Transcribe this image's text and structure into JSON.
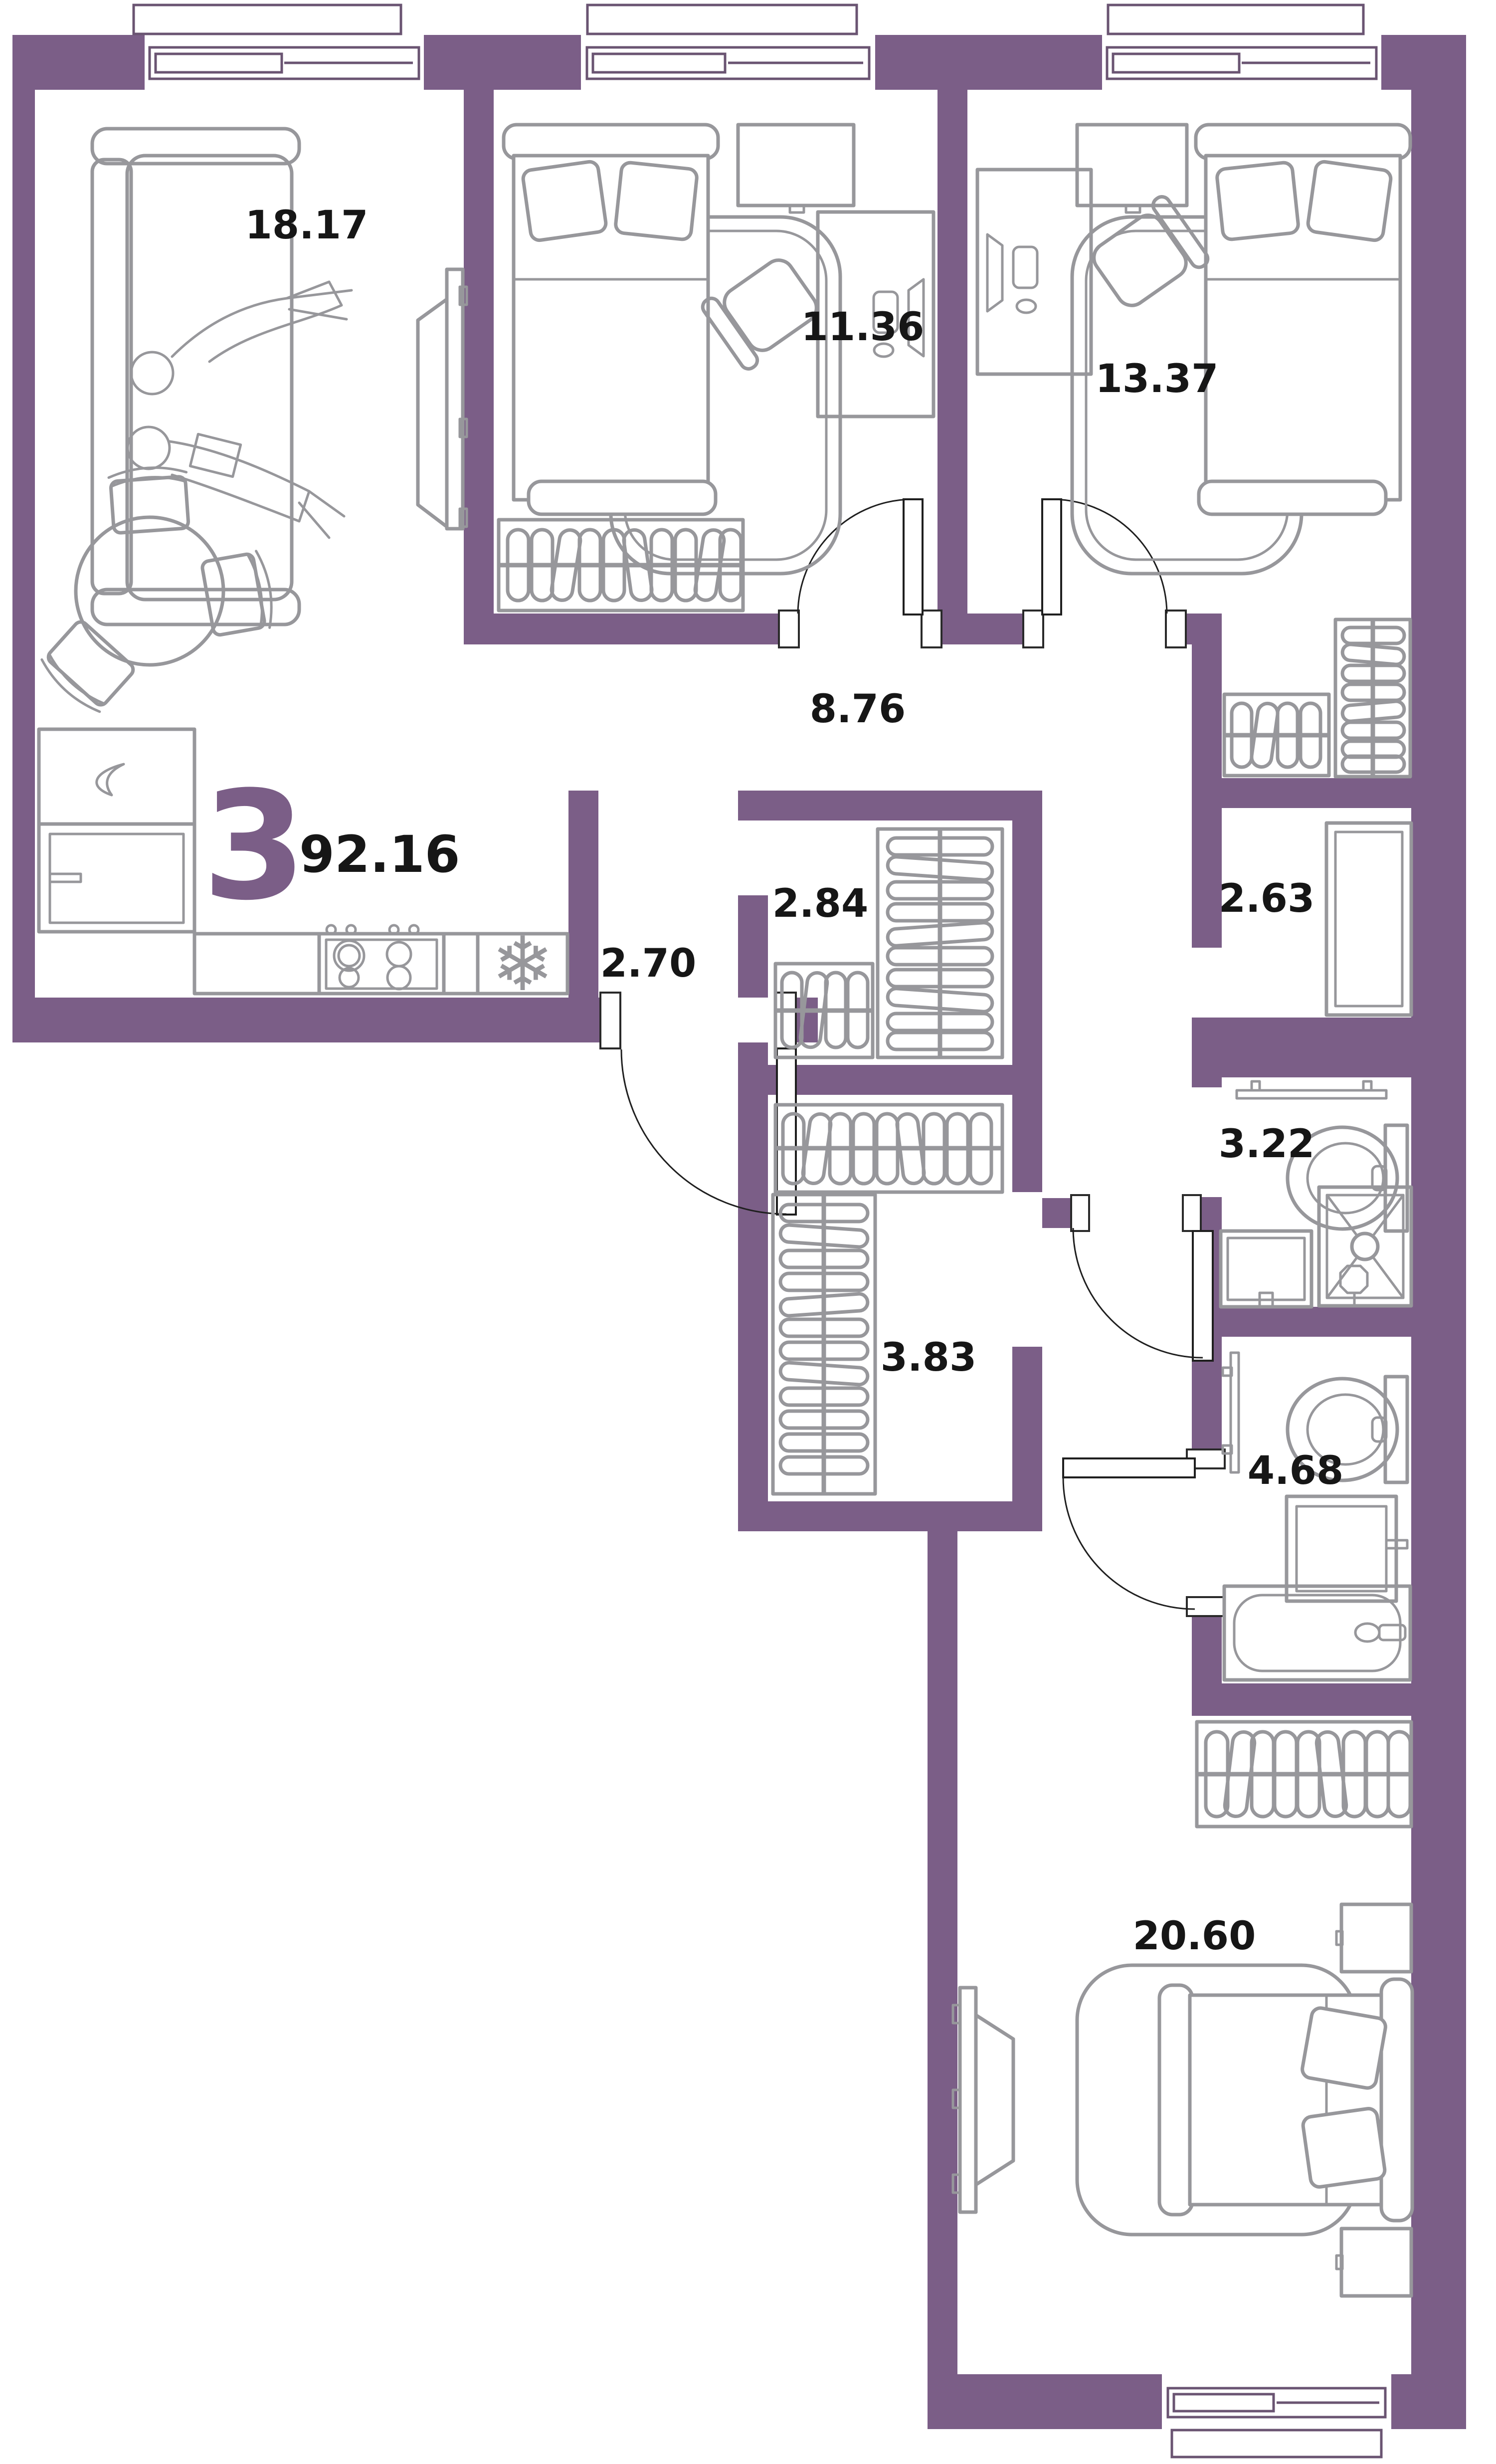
{
  "apartment": {
    "rooms_count": "3",
    "total_area": "92.16"
  },
  "rooms": {
    "living": "18.17",
    "bedroom1": "11.36",
    "bedroom2": "13.37",
    "hall": "8.76",
    "wardrobe": "2.84",
    "storage": "2.63",
    "entry": "2.70",
    "shower": "3.22",
    "closet": "3.83",
    "bath": "4.68",
    "bedroom3": "20.60"
  },
  "icons": {
    "snowflake": "❄"
  },
  "colors": {
    "wall": "#7b5e87",
    "furniture": "#97979b",
    "label": "#161616",
    "accent": "#7b5e87",
    "background": "#ffffff"
  }
}
